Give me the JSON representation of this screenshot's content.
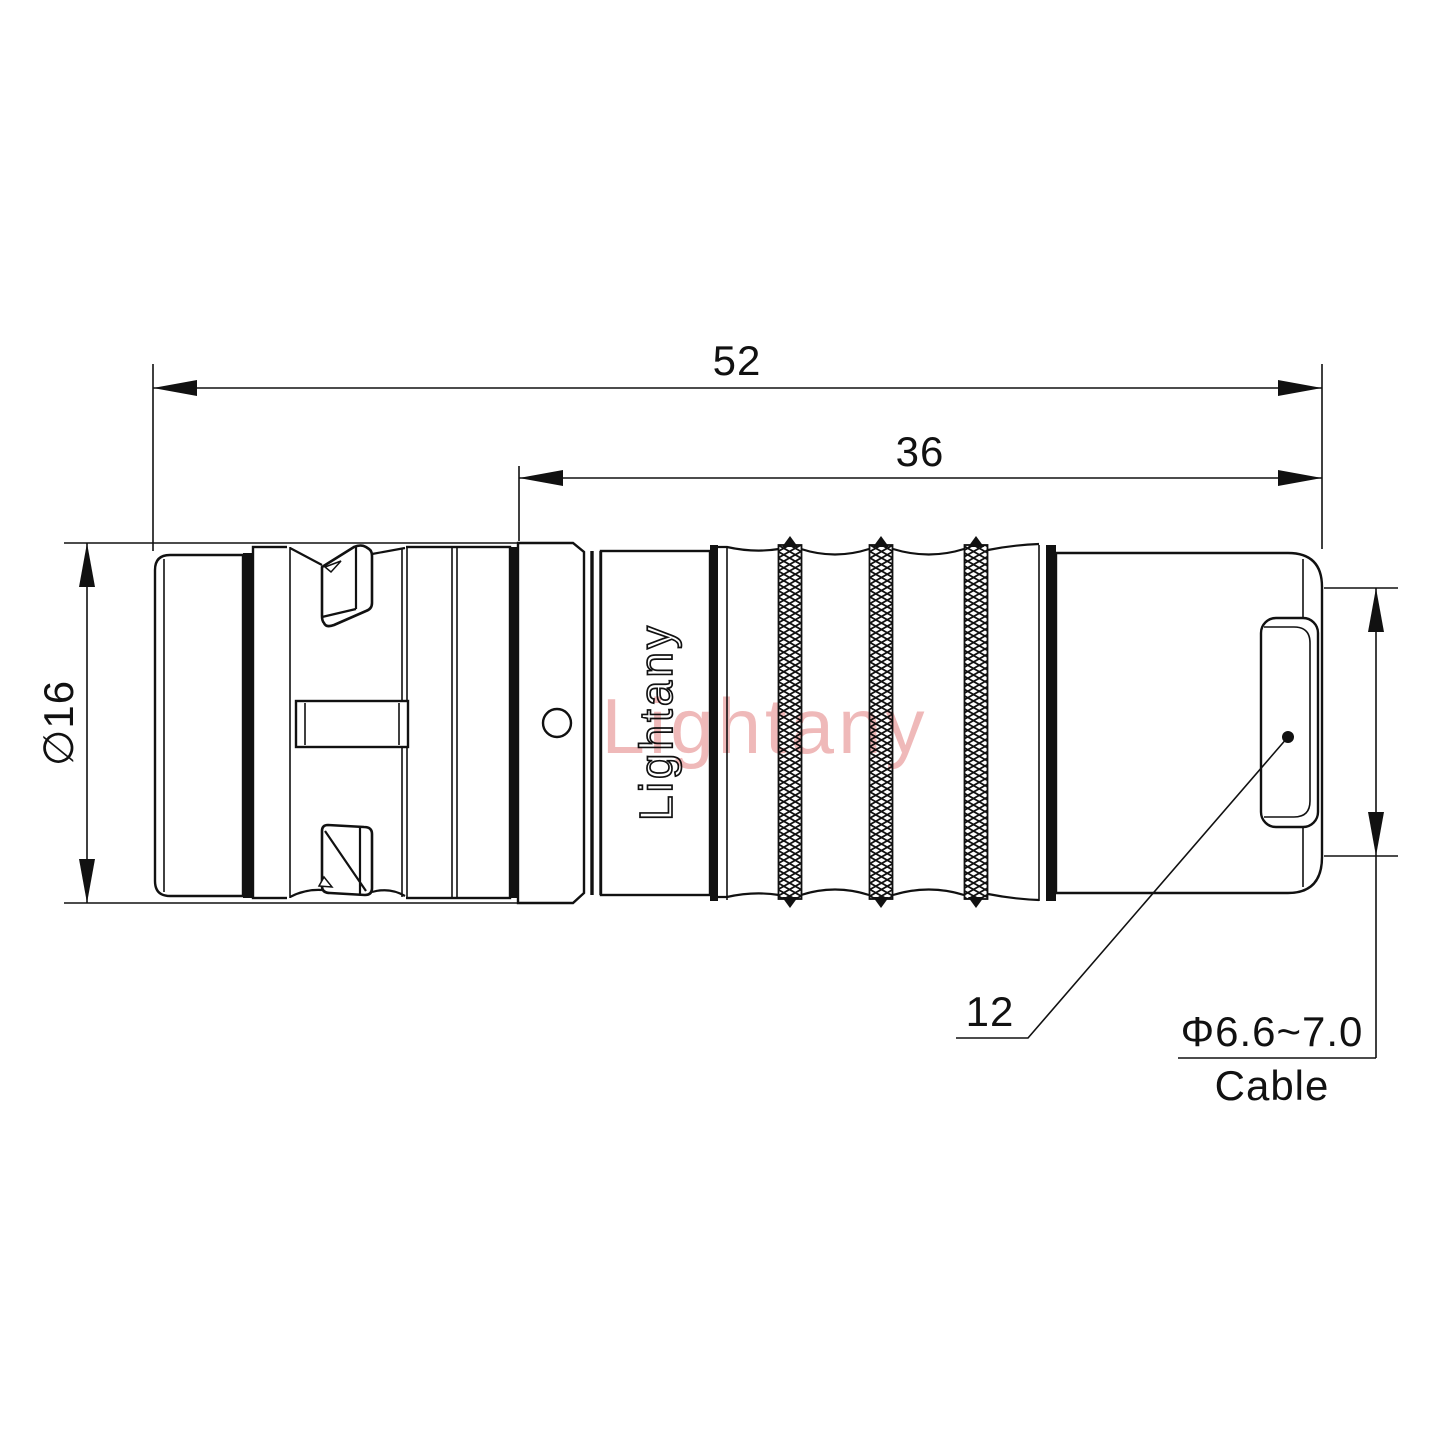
{
  "drawing": {
    "branding": {
      "engraving": "Lightany",
      "watermark": "Lightany"
    },
    "dimensions": {
      "overall_length": "52",
      "body_length": "36",
      "shell_diameter": "∅16",
      "rear_length": "12",
      "cable_diameter": "Φ6.6~7.0",
      "cable_label": "Cable"
    },
    "colors": {
      "line": "#111111",
      "background": "#ffffff",
      "watermark": "#edadad"
    }
  }
}
